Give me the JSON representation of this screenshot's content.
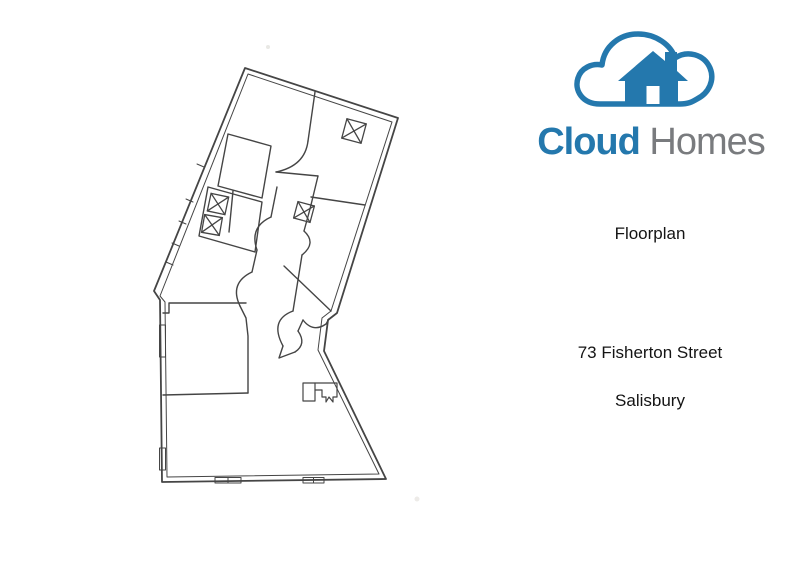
{
  "page": {
    "background_color": "#ffffff"
  },
  "branding": {
    "logo_icon": "cloud-house-icon",
    "name_part1": "Cloud",
    "name_part2": "Homes",
    "name_part1_color": "#2478ad",
    "name_part2_color": "#797b7e"
  },
  "property": {
    "document_label": "Floorplan",
    "address_line1": "73 Fisherton Street",
    "address_line2": "Salisbury"
  },
  "floorplan_drawing": {
    "type": "hand-drawn floor plan sketch, tilted footprint",
    "line_color": "#454545",
    "symbols": {
      "skylight_x_boxes": 4,
      "door_swing_arcs": true,
      "window_markings": true,
      "stair_detail": true
    }
  }
}
